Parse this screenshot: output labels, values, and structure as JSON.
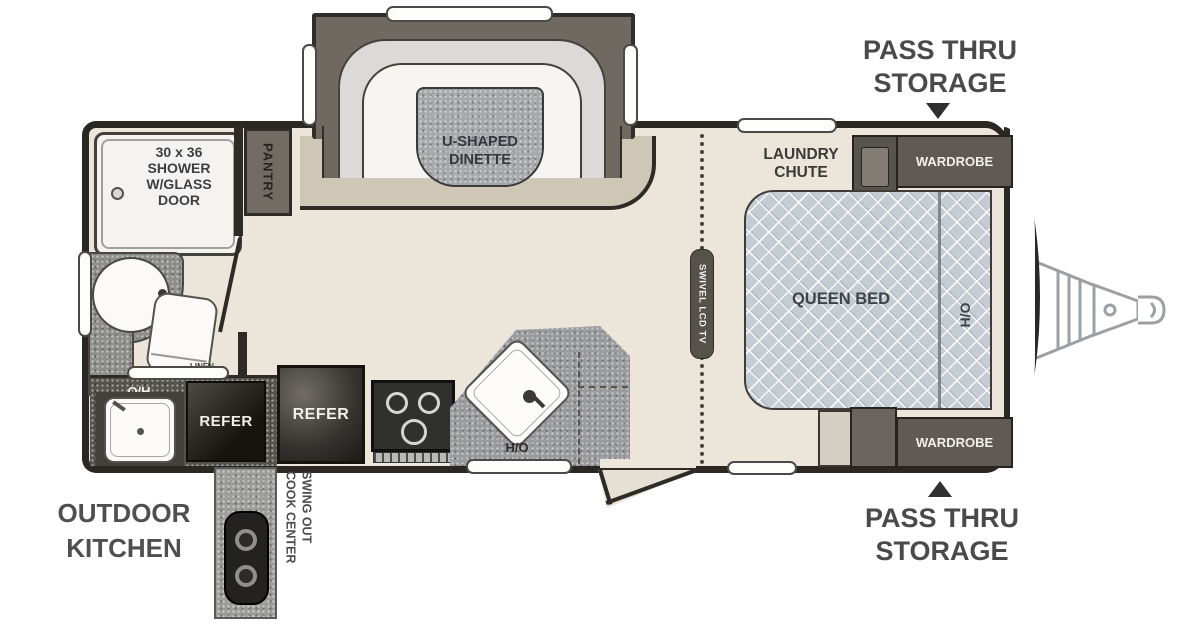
{
  "title": "Travel trailer floor plan",
  "colors": {
    "wall": "#2b2824",
    "floor": "#ebe5da",
    "slide_floor_band": "#cfc7b5",
    "bed_fill": "#c6ccd4",
    "cabinet_dark": "#605a54",
    "counter_gray": "#9a9b9e",
    "appliance_black": "#23221f",
    "label_gray": "#4a4a4a"
  },
  "labels": {
    "pass_thru_top_line1": "PASS THRU",
    "pass_thru_top_line2": "STORAGE",
    "pass_thru_bottom_line1": "PASS THRU",
    "pass_thru_bottom_line2": "STORAGE",
    "outdoor_kitchen_line1": "OUTDOOR",
    "outdoor_kitchen_line2": "KITCHEN",
    "swing_out_line1": "SWING OUT",
    "swing_out_line2": "COOK CENTER",
    "dinette_line1": "U-SHAPED",
    "dinette_line2": "DINETTE",
    "shower_line1": "30 x 36",
    "shower_line2": "SHOWER",
    "shower_line3": "W/GLASS",
    "shower_line4": "DOOR",
    "pantry": "PANTRY",
    "linen": "LINEN",
    "refer_indoor": "REFER",
    "refer_outdoor": "REFER",
    "oh_outdoor": "O/H",
    "oh_kitchen": "O/H",
    "oh_bed": "O/H",
    "swivel_tv": "SWIVEL LCD TV",
    "laundry_line1": "LAUNDRY",
    "laundry_line2": "CHUTE",
    "wardrobe_top": "WARDROBE",
    "wardrobe_bottom": "WARDROBE",
    "queen_bed": "QUEEN BED"
  }
}
